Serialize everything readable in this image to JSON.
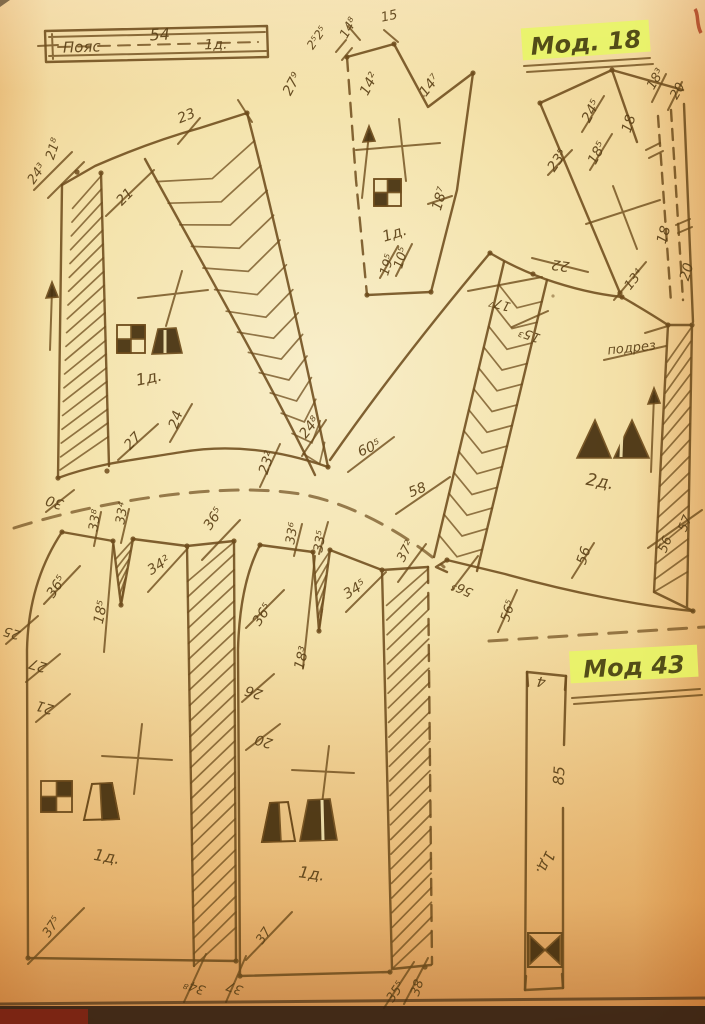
{
  "page": {
    "model_top_label": "Мод. 18",
    "model_bottom_label": "Мод 43"
  },
  "colors": {
    "ink": "#6e4c1c",
    "label_ink": "#5c4117",
    "highlight": "#e8f763",
    "symbol_fill": "#46300f",
    "paper_center": "#f6e9bd",
    "paper_edge": "#dfa258"
  },
  "annotations": [
    {
      "t": "Пояс",
      "x": 82,
      "y": 52,
      "r": -2,
      "fs": 15
    },
    {
      "t": "54",
      "x": 160,
      "y": 40,
      "r": -3,
      "fs": 16
    },
    {
      "t": "1д.",
      "x": 216,
      "y": 49,
      "r": -2,
      "fs": 14
    },
    {
      "t": "2⁵2⁵",
      "x": 320,
      "y": 40,
      "r": -55,
      "fs": 12
    },
    {
      "t": "14⁸",
      "x": 352,
      "y": 30,
      "r": -60,
      "fs": 13
    },
    {
      "t": "15",
      "x": 390,
      "y": 20,
      "r": -12,
      "fs": 13
    },
    {
      "t": "14²",
      "x": 373,
      "y": 86,
      "r": -62,
      "fs": 14
    },
    {
      "t": "14⁷",
      "x": 433,
      "y": 88,
      "r": -52,
      "fs": 14
    },
    {
      "t": "18⁷",
      "x": 444,
      "y": 200,
      "r": -73,
      "fs": 14
    },
    {
      "t": "19⁵",
      "x": 391,
      "y": 266,
      "r": -73,
      "fs": 13
    },
    {
      "t": "10⁵",
      "x": 405,
      "y": 259,
      "r": -73,
      "fs": 13
    },
    {
      "t": "1д.",
      "x": 396,
      "y": 238,
      "r": -18,
      "fs": 15
    },
    {
      "t": "24³",
      "x": 40,
      "y": 176,
      "r": -55,
      "fs": 13
    },
    {
      "t": "21⁸",
      "x": 57,
      "y": 150,
      "r": -72,
      "fs": 13
    },
    {
      "t": "21",
      "x": 128,
      "y": 200,
      "r": -45,
      "fs": 14
    },
    {
      "t": "23",
      "x": 188,
      "y": 120,
      "r": -22,
      "fs": 14
    },
    {
      "t": "27⁹",
      "x": 296,
      "y": 86,
      "r": -62,
      "fs": 14
    },
    {
      "t": "1д.",
      "x": 150,
      "y": 383,
      "r": -12,
      "fs": 16
    },
    {
      "t": "27",
      "x": 136,
      "y": 444,
      "r": -48,
      "fs": 14
    },
    {
      "t": "24",
      "x": 180,
      "y": 421,
      "r": -72,
      "fs": 14
    },
    {
      "t": "23²",
      "x": 271,
      "y": 464,
      "r": -72,
      "fs": 14
    },
    {
      "t": "24⁸",
      "x": 313,
      "y": 430,
      "r": -52,
      "fs": 14
    },
    {
      "t": "30",
      "x": 56,
      "y": 498,
      "r": 198,
      "fs": 14
    },
    {
      "t": "22",
      "x": 561,
      "y": 261,
      "r": 188,
      "fs": 14
    },
    {
      "t": "17⁷",
      "x": 501,
      "y": 300,
      "r": 196,
      "fs": 13
    },
    {
      "t": "15³",
      "x": 531,
      "y": 331,
      "r": 200,
      "fs": 13
    },
    {
      "t": "подрез",
      "x": 632,
      "y": 352,
      "r": -6,
      "fs": 13
    },
    {
      "t": "2д.",
      "x": 599,
      "y": 487,
      "r": 10,
      "fs": 17
    },
    {
      "t": "60⁵",
      "x": 371,
      "y": 452,
      "r": -24,
      "fs": 14
    },
    {
      "t": "58",
      "x": 419,
      "y": 494,
      "r": -22,
      "fs": 14
    },
    {
      "t": "57",
      "x": 689,
      "y": 525,
      "r": -68,
      "fs": 13
    },
    {
      "t": "56",
      "x": 669,
      "y": 546,
      "r": -68,
      "fs": 13
    },
    {
      "t": "56",
      "x": 588,
      "y": 557,
      "r": -72,
      "fs": 14
    },
    {
      "t": "56⁵",
      "x": 464,
      "y": 585,
      "r": 205,
      "fs": 13
    },
    {
      "t": "56⁵",
      "x": 512,
      "y": 612,
      "r": -72,
      "fs": 13
    },
    {
      "t": "13⁴",
      "x": 637,
      "y": 282,
      "r": -52,
      "fs": 13
    },
    {
      "t": "23⁵",
      "x": 561,
      "y": 163,
      "r": -55,
      "fs": 14
    },
    {
      "t": "24⁵",
      "x": 595,
      "y": 113,
      "r": -62,
      "fs": 14
    },
    {
      "t": "18⁵",
      "x": 601,
      "y": 155,
      "r": -62,
      "fs": 14
    },
    {
      "t": "18",
      "x": 633,
      "y": 125,
      "r": -72,
      "fs": 14
    },
    {
      "t": "18³",
      "x": 659,
      "y": 81,
      "r": -60,
      "fs": 13
    },
    {
      "t": "20",
      "x": 681,
      "y": 93,
      "r": -60,
      "fs": 13
    },
    {
      "t": "18",
      "x": 668,
      "y": 236,
      "r": -74,
      "fs": 14
    },
    {
      "t": "20",
      "x": 691,
      "y": 273,
      "r": -74,
      "fs": 14
    },
    {
      "t": "33⁸",
      "x": 99,
      "y": 521,
      "r": -80,
      "fs": 13
    },
    {
      "t": "33⁴",
      "x": 126,
      "y": 514,
      "r": -80,
      "fs": 13
    },
    {
      "t": "36⁵",
      "x": 60,
      "y": 589,
      "r": -56,
      "fs": 14
    },
    {
      "t": "34²",
      "x": 161,
      "y": 569,
      "r": -32,
      "fs": 14
    },
    {
      "t": "36⁵",
      "x": 217,
      "y": 521,
      "r": -56,
      "fs": 14
    },
    {
      "t": "18⁵",
      "x": 105,
      "y": 613,
      "r": -78,
      "fs": 14
    },
    {
      "t": "25",
      "x": 13,
      "y": 629,
      "r": 196,
      "fs": 13
    },
    {
      "t": "27",
      "x": 39,
      "y": 661,
      "r": 196,
      "fs": 14
    },
    {
      "t": "21",
      "x": 46,
      "y": 703,
      "r": 196,
      "fs": 14
    },
    {
      "t": "1д.",
      "x": 106,
      "y": 862,
      "r": 10,
      "fs": 16
    },
    {
      "t": "37⁵",
      "x": 55,
      "y": 929,
      "r": -56,
      "fs": 13
    },
    {
      "t": "34⁸",
      "x": 196,
      "y": 983,
      "r": 200,
      "fs": 13
    },
    {
      "t": "37",
      "x": 236,
      "y": 984,
      "r": 200,
      "fs": 13
    },
    {
      "t": "33⁶",
      "x": 296,
      "y": 534,
      "r": -80,
      "fs": 13
    },
    {
      "t": "33⁵",
      "x": 324,
      "y": 542,
      "r": -80,
      "fs": 13
    },
    {
      "t": "36⁵",
      "x": 266,
      "y": 617,
      "r": -56,
      "fs": 14
    },
    {
      "t": "34⁵",
      "x": 357,
      "y": 593,
      "r": -32,
      "fs": 14
    },
    {
      "t": "37²",
      "x": 409,
      "y": 553,
      "r": -62,
      "fs": 13
    },
    {
      "t": "18³",
      "x": 306,
      "y": 659,
      "r": -76,
      "fs": 14
    },
    {
      "t": "26",
      "x": 255,
      "y": 688,
      "r": 196,
      "fs": 14
    },
    {
      "t": "20",
      "x": 265,
      "y": 737,
      "r": 196,
      "fs": 14
    },
    {
      "t": "1д.",
      "x": 311,
      "y": 879,
      "r": 8,
      "fs": 16
    },
    {
      "t": "37",
      "x": 267,
      "y": 938,
      "r": -56,
      "fs": 13
    },
    {
      "t": "38",
      "x": 421,
      "y": 989,
      "r": -72,
      "fs": 13
    },
    {
      "t": "35⁵",
      "x": 399,
      "y": 994,
      "r": -56,
      "fs": 13
    },
    {
      "t": "4",
      "x": 542,
      "y": 677,
      "r": 188,
      "fs": 14
    },
    {
      "t": "85",
      "x": 564,
      "y": 776,
      "r": -86,
      "fs": 15
    },
    {
      "t": "1д.",
      "x": 541,
      "y": 861,
      "r": 115,
      "fs": 15
    }
  ]
}
